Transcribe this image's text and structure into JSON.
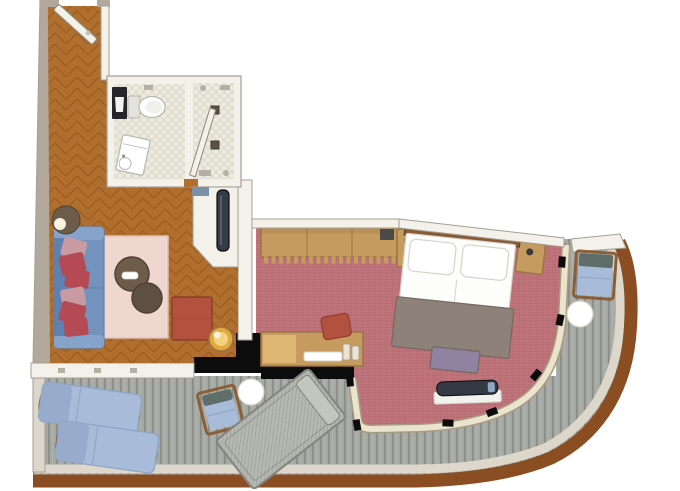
{
  "scene": {
    "kind": "floor-plan",
    "view": "top-down",
    "description": "balcony suite floor plan with curved ship-hull terrace"
  },
  "rooms": {
    "entry_hall": {
      "floor": "herringbone-parquet"
    },
    "bathroom": {
      "floor": "tile",
      "fixtures": [
        "toilet",
        "vanity-sink",
        "storage-cabinet"
      ]
    },
    "shower_room": {
      "floor": "tile",
      "fixtures": [
        "floor-drain",
        "floor-drain"
      ]
    },
    "closet_nook": {
      "items": [
        "tall-cabinet",
        "wall-shelf"
      ]
    },
    "living_room": {
      "floor": "herringbone-parquet",
      "items": [
        "sofa",
        "throw-pillows",
        "floor-lamp",
        "area-rug",
        "coffee-table-large",
        "coffee-table-small",
        "ottoman",
        "lamp-side-table"
      ]
    },
    "bedroom": {
      "floor": "carpet",
      "items": [
        "wardrobe-with-hangers",
        "nightstand-left",
        "nightstand-right",
        "double-bed",
        "foot-bench",
        "tv-console",
        "desk",
        "desk-chair"
      ]
    },
    "balcony": {
      "floor": "deck-planks",
      "items": [
        "sun-lounger",
        "sun-lounger",
        "deck-armchair",
        "deck-armchair",
        "round-side-table",
        "round-side-table",
        "daybed"
      ]
    }
  },
  "doors": [
    "entry-door",
    "bathroom-door"
  ],
  "palette": {
    "bg": "#ffffff",
    "wood": "#b06f2e",
    "woodLine": "#7e4a14",
    "wallFill": "#f3f1ea",
    "wallStroke": "#a59f93",
    "wallBeige": "#b2a99c",
    "tile": "#edebe0",
    "tileLine": "#d7d2c0",
    "black": "#0c0c0c",
    "carpet": "#c1767d",
    "carpetLine": "#a55a62",
    "deck": "#a6a9a3",
    "deckLine": "#898c86",
    "deckLight": "#bcbfb9",
    "railing": "#8b4e22",
    "lightBand": "#dcd7ca",
    "windowBand": "#ece3cd",
    "windowBandStroke": "#a69b83",
    "sofa": "#7393be",
    "sofaLight": "#86a4cb",
    "sofaDark": "#5e81af",
    "pillowRed": "#b34a54",
    "pillowPink": "#c89aa2",
    "rug": "#efd7cf",
    "rugEdge": "#dfc0b8",
    "tableBrown": "#6d5c4a",
    "tableBrown2": "#5d4f41",
    "tableEdge": "#4e4234",
    "ottoman": "#b2513d",
    "ottomanEdge": "#8e3e2d",
    "gold": "#e2a93e",
    "goldLight": "#f3d381",
    "tan": "#c69b60",
    "tanDark": "#9a7543",
    "headboard": "#8a5a33",
    "bedWhite": "#fdfdfb",
    "bedEdge": "#d6d3c9",
    "blanket": "#8e8179",
    "blanketEdge": "#746960",
    "benchPurple": "#9082a1",
    "tvDark": "#333a46",
    "tvBase": "#f1f1ed",
    "tvAccent": "#8fa7c0",
    "loungerBlue": "#a8bcd9",
    "loungerEdge": "#8ba3c6",
    "loungerShade": "#97accd",
    "woodFrame": "#8a5f38",
    "daybed": "#b6b8b2",
    "daybedEdge": "#83857e",
    "closetObject": "#343c48",
    "shelfBlue": "#7e90a7",
    "white": "#ffffff",
    "fixtureGray": "#b4b0a5",
    "glow": "#f8f3e0",
    "doorLeaf": "#f4f1e8",
    "doorEdge": "#8e897e",
    "toiletEdge": "#b7b7ae"
  }
}
